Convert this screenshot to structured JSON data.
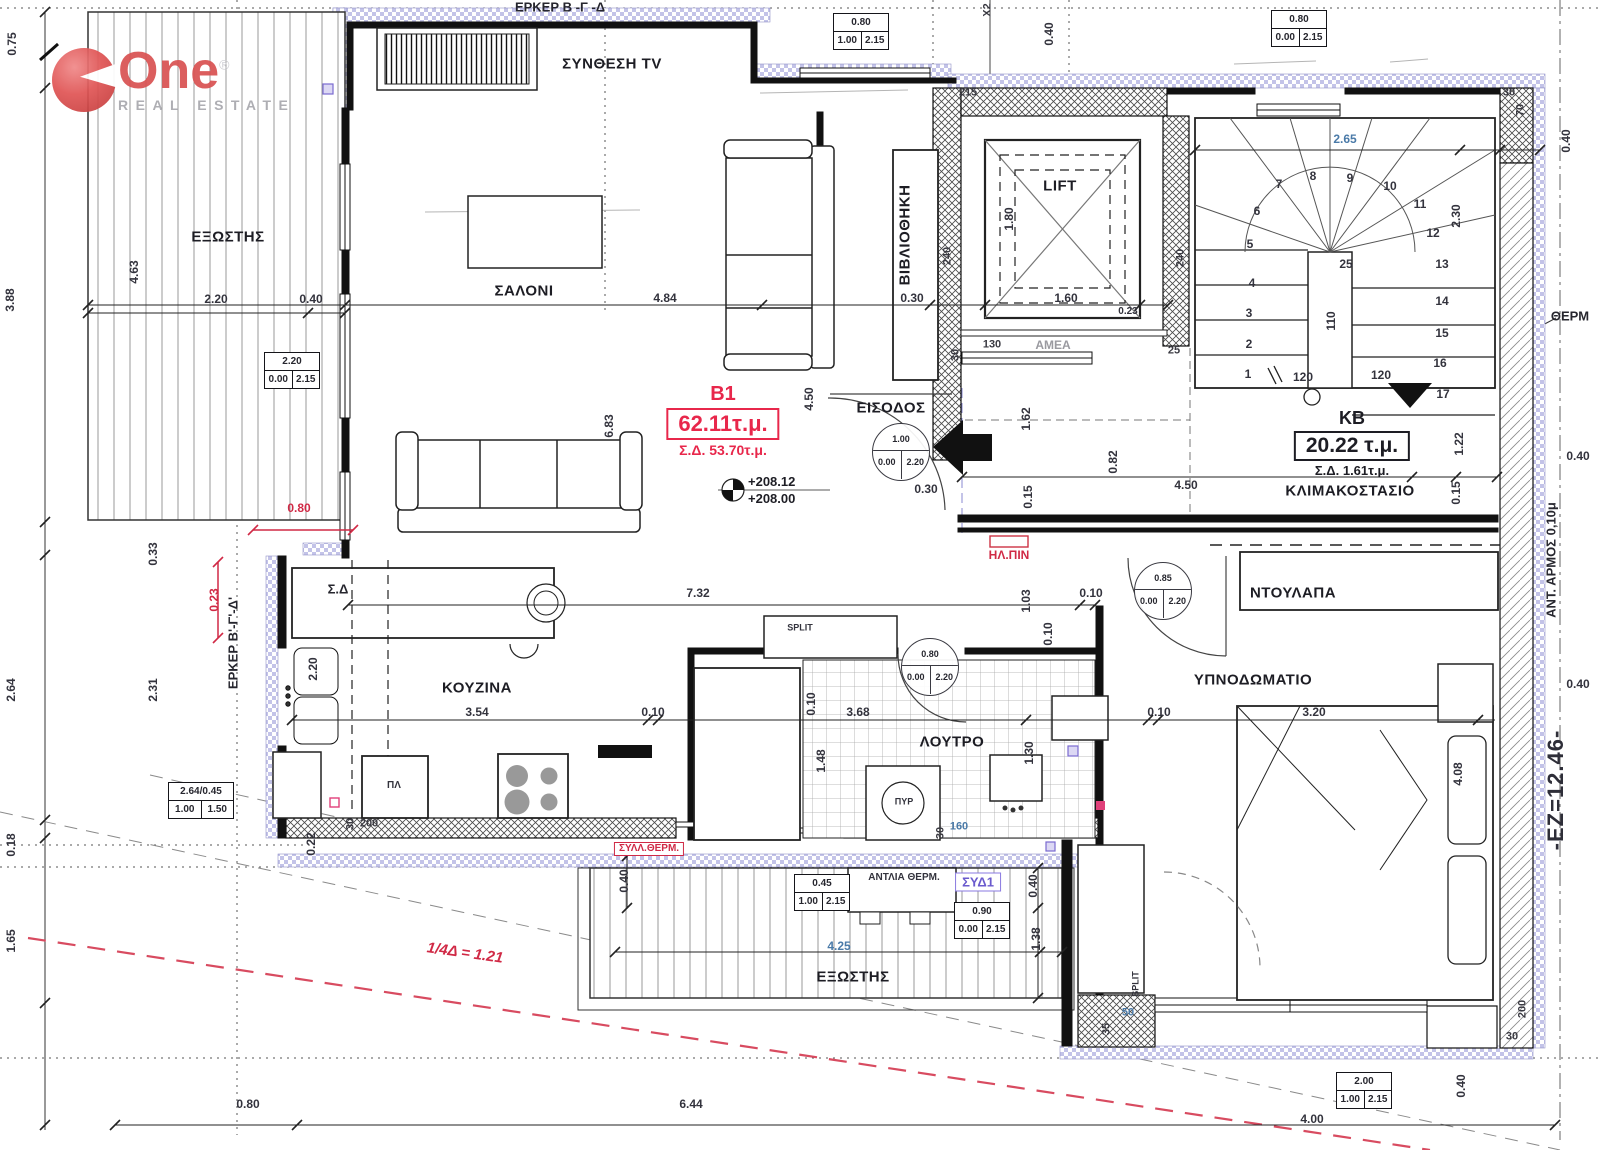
{
  "logo": {
    "brand": "One",
    "reg": "®",
    "sub": "REAL ESTATE"
  },
  "apartment_stamp": {
    "id": "B1",
    "area": "62.11τ.μ.",
    "sd": "Σ.Δ. 53.70τ.μ."
  },
  "kb_stamp": {
    "id": "KB",
    "area": "20.22 τ.μ.",
    "sd": "Σ.Δ. 1.61τ.μ."
  },
  "levels": {
    "upper": "+208.12",
    "lower": "+208.00"
  },
  "rooms": {
    "tv": "ΣΥΝΘΕΣΗ TV",
    "balcony_left": "ΕΞΩΣΤΗΣ",
    "living": "ΣΑΛΟΝΙ",
    "library": "ΒΙΒΛΙΟΘΗΚΗ",
    "lift": "LIFT",
    "entrance": "ΕΙΣΟΔΟΣ",
    "stairwell": "ΚΛΙΜΑΚΟΣΤΑΣΙΟ",
    "kitchen": "ΚΟΥΖΙΝΑ",
    "bath": "ΛΟΥΤΡΟ",
    "bedroom": "ΥΠΝΟΔΩΜΑΤΙΟ",
    "closet": "ΝΤΟΥΛΑΠΑ",
    "balcony_bottom": "ΕΞΩΣΤΗΣ"
  },
  "annotations": [
    {
      "t": "ΣΥΝΘΕΣΗ TV",
      "x": 612,
      "y": 64,
      "c": "room",
      "n": "room-label-tv"
    },
    {
      "t": "ΕΞΩΣΤΗΣ",
      "x": 228,
      "y": 237,
      "c": "room",
      "n": "room-label-balcony-left"
    },
    {
      "t": "ΣΑΛΟΝΙ",
      "x": 524,
      "y": 291,
      "c": "room",
      "n": "room-label-living"
    },
    {
      "t": "ΒΙΒΛΙΟΘΗΚΗ",
      "x": 905,
      "y": 235,
      "r": -90,
      "c": "room",
      "n": "room-label-library"
    },
    {
      "t": "LIFT",
      "x": 1060,
      "y": 186,
      "c": "room",
      "n": "room-label-lift"
    },
    {
      "t": "ΕΙΣΟΔΟΣ",
      "x": 891,
      "y": 408,
      "c": "room",
      "n": "room-label-entrance"
    },
    {
      "t": "ΚΛΙΜΑΚΟΣΤΑΣΙΟ",
      "x": 1350,
      "y": 491,
      "c": "room",
      "n": "room-label-stairwell"
    },
    {
      "t": "ΚΟΥΖΙΝΑ",
      "x": 477,
      "y": 688,
      "c": "room",
      "n": "room-label-kitchen"
    },
    {
      "t": "ΛΟΥΤΡΟ",
      "x": 952,
      "y": 742,
      "c": "room",
      "n": "room-label-bath"
    },
    {
      "t": "ΥΠΝΟΔΩΜΑΤΙΟ",
      "x": 1253,
      "y": 680,
      "c": "room",
      "n": "room-label-bedroom"
    },
    {
      "t": "ΝΤΟΥΛΑΠΑ",
      "x": 1293,
      "y": 593,
      "c": "room",
      "n": "room-label-closet"
    },
    {
      "t": "ΕΞΩΣΤΗΣ",
      "x": 853,
      "y": 977,
      "c": "room",
      "n": "room-label-balcony-bottom"
    },
    {
      "t": "ΕΡΚΕΡ Β -Γ -Δ",
      "x": 560,
      "y": 7,
      "c": "hdr",
      "n": "erker-label-top"
    },
    {
      "t": "ΕΡΚΕΡ Β'-Γ'-Δ'",
      "x": 233,
      "y": 643,
      "r": -90,
      "c": "hdr",
      "n": "erker-label-left"
    },
    {
      "t": "Σ.Δ",
      "x": 338,
      "y": 589,
      "c": "hdr"
    },
    {
      "t": "ΑΜΕΑ",
      "x": 1053,
      "y": 345,
      "c": "gray"
    },
    {
      "t": "SPLIT",
      "x": 800,
      "y": 628,
      "c": "tiny"
    },
    {
      "t": "SPLIT",
      "x": 1136,
      "y": 984,
      "r": -90,
      "c": "tiny"
    },
    {
      "t": "ΠΥΡ",
      "x": 904,
      "y": 802,
      "c": "tiny"
    },
    {
      "t": "ΠΛ",
      "x": 394,
      "y": 786,
      "c": "small"
    },
    {
      "t": "ΑΝΤΛΙΑ ΘΕΡΜ.",
      "x": 904,
      "y": 878,
      "c": "small"
    },
    {
      "t": "ΣΥΔ1",
      "x": 978,
      "y": 882,
      "c": "bluebox",
      "n": "syd1-tag"
    },
    {
      "t": "ΣΥΛΛ.ΘΕΡΜ.",
      "x": 649,
      "y": 849,
      "c": "redbox",
      "n": "syll-therm-tag"
    },
    {
      "t": "ΗΛ.ΠΙΝ",
      "x": 1009,
      "y": 555,
      "c": "red",
      "n": "electrical-panel-label"
    },
    {
      "t": "ΘΕΡΜ",
      "x": 1570,
      "y": 316,
      "c": "hdr",
      "n": "therm-label"
    },
    {
      "t": "ΑΝΤ. ΑΡΜΟΣ 0,10μ",
      "x": 1551,
      "y": 560,
      "r": -90,
      "c": "hdr",
      "n": "seismic-joint-label"
    },
    {
      "t": "-ΕΖ=12.46-",
      "x": 1556,
      "y": 790,
      "r": -90,
      "c": "big",
      "n": "ez-level-label"
    },
    {
      "t": "1/4Δ = 1.21",
      "x": 465,
      "y": 953,
      "r": 8,
      "c": "redbig",
      "n": "quarter-d-label"
    },
    {
      "t": "Χ2",
      "x": 988,
      "y": 10,
      "r": -90,
      "c": "wall"
    },
    {
      "t": "0.75",
      "x": 12,
      "y": 44,
      "r": -90
    },
    {
      "t": "3.88",
      "x": 10,
      "y": 300,
      "r": -90
    },
    {
      "t": "4.63",
      "x": 134,
      "y": 272,
      "r": -90
    },
    {
      "t": "2.20",
      "x": 216,
      "y": 299
    },
    {
      "t": "0.40",
      "x": 311,
      "y": 299
    },
    {
      "t": "4.84",
      "x": 665,
      "y": 298
    },
    {
      "t": "0.30",
      "x": 912,
      "y": 298
    },
    {
      "t": "1.60",
      "x": 1066,
      "y": 298
    },
    {
      "t": "0.23",
      "x": 1128,
      "y": 312,
      "c": "small"
    },
    {
      "t": "2.65",
      "x": 1345,
      "y": 139,
      "c": "blue"
    },
    {
      "t": "2.30",
      "x": 1456,
      "y": 216,
      "r": -90
    },
    {
      "t": "6.83",
      "x": 609,
      "y": 426,
      "r": -90
    },
    {
      "t": "4.50",
      "x": 809,
      "y": 399,
      "r": -90
    },
    {
      "t": "4.50",
      "x": 1186,
      "y": 485
    },
    {
      "t": "1.22",
      "x": 1459,
      "y": 444,
      "r": -90
    },
    {
      "t": "0.15",
      "x": 1456,
      "y": 493,
      "r": -90
    },
    {
      "t": "1.80",
      "x": 1009,
      "y": 219,
      "r": -90
    },
    {
      "t": "1.62",
      "x": 1026,
      "y": 419,
      "r": -90
    },
    {
      "t": "0.82",
      "x": 1113,
      "y": 462,
      "r": -90
    },
    {
      "t": "0.15",
      "x": 1028,
      "y": 497,
      "r": -90
    },
    {
      "t": "0.30",
      "x": 926,
      "y": 489
    },
    {
      "t": "7.32",
      "x": 698,
      "y": 593
    },
    {
      "t": "0.10",
      "x": 1091,
      "y": 593
    },
    {
      "t": "1.03",
      "x": 1026,
      "y": 601,
      "r": -90
    },
    {
      "t": "0.10",
      "x": 1048,
      "y": 634,
      "r": -90
    },
    {
      "t": "3.54",
      "x": 477,
      "y": 712
    },
    {
      "t": "0.10",
      "x": 653,
      "y": 712
    },
    {
      "t": "3.68",
      "x": 858,
      "y": 712
    },
    {
      "t": "0.10",
      "x": 1159,
      "y": 712
    },
    {
      "t": "3.20",
      "x": 1314,
      "y": 712
    },
    {
      "t": "1.30",
      "x": 1029,
      "y": 753,
      "r": -90
    },
    {
      "t": "1.48",
      "x": 821,
      "y": 761,
      "r": -90
    },
    {
      "t": "0.10",
      "x": 811,
      "y": 704,
      "r": -90
    },
    {
      "t": "4.08",
      "x": 1458,
      "y": 774,
      "r": -90
    },
    {
      "t": "2.20",
      "x": 313,
      "y": 669,
      "r": -90
    },
    {
      "t": "0.33",
      "x": 153,
      "y": 554,
      "r": -90
    },
    {
      "t": "2.64",
      "x": 11,
      "y": 690,
      "r": -90
    },
    {
      "t": "2.31",
      "x": 153,
      "y": 690,
      "r": -90
    },
    {
      "t": "0.18",
      "x": 11,
      "y": 845,
      "r": -90
    },
    {
      "t": "1.65",
      "x": 11,
      "y": 941,
      "r": -90
    },
    {
      "t": "0.22",
      "x": 311,
      "y": 844,
      "r": -90
    },
    {
      "t": "0.23",
      "x": 214,
      "y": 600,
      "r": -90,
      "c": "red"
    },
    {
      "t": "0.80",
      "x": 299,
      "y": 508,
      "c": "red"
    },
    {
      "t": "0.40",
      "x": 624,
      "y": 881,
      "r": -90
    },
    {
      "t": "0.40",
      "x": 1033,
      "y": 886,
      "r": -90
    },
    {
      "t": "1.38",
      "x": 1036,
      "y": 939,
      "r": -90
    },
    {
      "t": "4.25",
      "x": 839,
      "y": 946,
      "c": "blue"
    },
    {
      "t": "0.80",
      "x": 248,
      "y": 1104
    },
    {
      "t": "6.44",
      "x": 691,
      "y": 1104
    },
    {
      "t": "4.00",
      "x": 1312,
      "y": 1119
    },
    {
      "t": "0.40",
      "x": 1049,
      "y": 34,
      "r": -90
    },
    {
      "t": "0.40",
      "x": 1566,
      "y": 141,
      "r": -90
    },
    {
      "t": "0.40",
      "x": 1578,
      "y": 456
    },
    {
      "t": "0.40",
      "x": 1578,
      "y": 684
    },
    {
      "t": "0.40",
      "x": 1461,
      "y": 1086,
      "r": -90
    },
    {
      "t": "215",
      "x": 968,
      "y": 93,
      "c": "wall"
    },
    {
      "t": "240",
      "x": 948,
      "y": 256,
      "r": -90,
      "c": "wall"
    },
    {
      "t": "240",
      "x": 1181,
      "y": 258,
      "r": -90,
      "c": "wall"
    },
    {
      "t": "130",
      "x": 992,
      "y": 345,
      "c": "wall"
    },
    {
      "t": "30",
      "x": 956,
      "y": 355,
      "r": -90,
      "c": "wall"
    },
    {
      "t": "25",
      "x": 1174,
      "y": 351,
      "c": "wall"
    },
    {
      "t": "30",
      "x": 1509,
      "y": 93,
      "c": "wall"
    },
    {
      "t": "70",
      "x": 1521,
      "y": 110,
      "r": -90,
      "c": "wall"
    },
    {
      "t": "200",
      "x": 369,
      "y": 824,
      "c": "wall"
    },
    {
      "t": "30",
      "x": 351,
      "y": 824,
      "r": -90,
      "c": "wall"
    },
    {
      "t": "160",
      "x": 959,
      "y": 827,
      "c": "bluewall"
    },
    {
      "t": "30",
      "x": 941,
      "y": 833,
      "r": -90,
      "c": "wall"
    },
    {
      "t": "50",
      "x": 1128,
      "y": 1013,
      "c": "bluewall"
    },
    {
      "t": "35",
      "x": 1107,
      "y": 1029,
      "r": -90,
      "c": "wall"
    },
    {
      "t": "200",
      "x": 1523,
      "y": 1009,
      "r": -90,
      "c": "wall"
    },
    {
      "t": "30",
      "x": 1512,
      "y": 1037,
      "c": "wall"
    },
    {
      "t": "1",
      "x": 1248,
      "y": 374
    },
    {
      "t": "2",
      "x": 1249,
      "y": 344
    },
    {
      "t": "3",
      "x": 1249,
      "y": 313
    },
    {
      "t": "4",
      "x": 1252,
      "y": 283
    },
    {
      "t": "5",
      "x": 1250,
      "y": 244
    },
    {
      "t": "6",
      "x": 1257,
      "y": 211
    },
    {
      "t": "7",
      "x": 1279,
      "y": 184
    },
    {
      "t": "8",
      "x": 1313,
      "y": 176
    },
    {
      "t": "9",
      "x": 1350,
      "y": 178
    },
    {
      "t": "10",
      "x": 1390,
      "y": 186
    },
    {
      "t": "11",
      "x": 1420,
      "y": 204
    },
    {
      "t": "12",
      "x": 1433,
      "y": 233
    },
    {
      "t": "13",
      "x": 1442,
      "y": 264
    },
    {
      "t": "14",
      "x": 1442,
      "y": 301
    },
    {
      "t": "15",
      "x": 1442,
      "y": 333
    },
    {
      "t": "16",
      "x": 1440,
      "y": 363
    },
    {
      "t": "17",
      "x": 1443,
      "y": 394
    },
    {
      "t": "25",
      "x": 1346,
      "y": 264
    },
    {
      "t": "110",
      "x": 1331,
      "y": 321,
      "r": -90
    },
    {
      "t": "120",
      "x": 1303,
      "y": 377
    },
    {
      "t": "120",
      "x": 1381,
      "y": 375
    }
  ],
  "window_tags": [
    {
      "top": "2.20",
      "a": "0.00",
      "b": "2.15",
      "x": 264,
      "y": 352
    },
    {
      "top": "0.80",
      "a": "1.00",
      "b": "2.15",
      "x": 833,
      "y": 13
    },
    {
      "top": "0.80",
      "a": "0.00",
      "b": "2.15",
      "x": 1271,
      "y": 10
    },
    {
      "top": "2.64/0.45",
      "a": "1.00",
      "b": "1.50",
      "x": 168,
      "y": 782,
      "w": 64
    },
    {
      "top": "0.45",
      "a": "1.00",
      "b": "2.15",
      "x": 794,
      "y": 874
    },
    {
      "top": "0.90",
      "a": "0.00",
      "b": "2.15",
      "x": 954,
      "y": 902
    },
    {
      "top": "2.00",
      "a": "1.00",
      "b": "2.15",
      "x": 1336,
      "y": 1072
    }
  ],
  "door_tags": [
    {
      "top": "1.00",
      "a": "0.00",
      "b": "2.20",
      "cx": 901,
      "cy": 452
    },
    {
      "top": "0.85",
      "a": "0.00",
      "b": "2.20",
      "cx": 1163,
      "cy": 591
    },
    {
      "top": "0.80",
      "a": "0.00",
      "b": "2.20",
      "cx": 930,
      "cy": 667
    }
  ]
}
